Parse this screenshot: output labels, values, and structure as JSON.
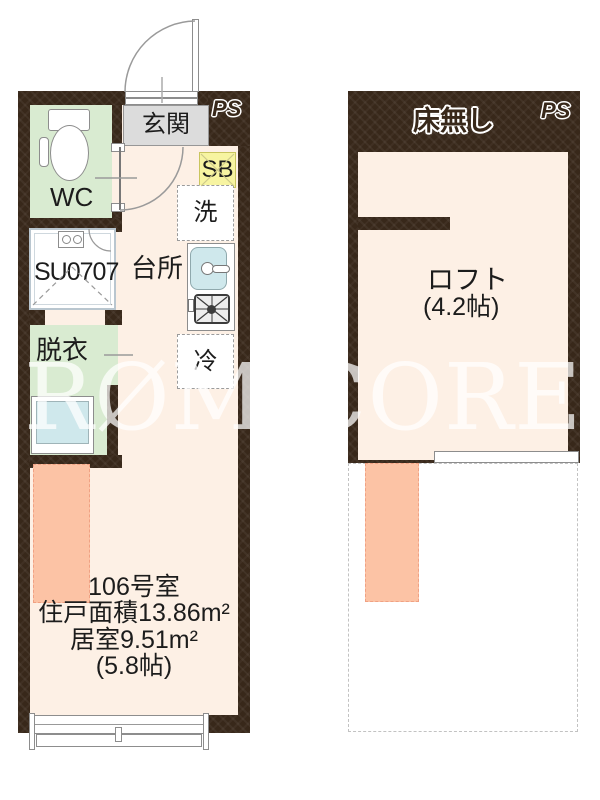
{
  "watermark": "RØM CORE",
  "colors": {
    "wall": "#38281a",
    "floor": "#fdf0e5",
    "wet_room_green": "#d9ebd1",
    "entry_gray": "#dcdcdc",
    "shoe_box_yellow": "#f7f4a1",
    "fixture_blue": "#cfe8ec",
    "loft_highlight_salmon": "#fcc3a5"
  },
  "main_plan": {
    "entrance": "玄関",
    "ps": "PS",
    "wc": "WC",
    "shoe_box": "SB",
    "washer": "洗",
    "kitchen": "台所",
    "unit_bath": "SU0707",
    "dressing": "脱衣",
    "fridge": "冷",
    "room_number": "106号室",
    "unit_area": "住戸面積13.86m²",
    "living_area": "居室9.51m²",
    "living_tatami": "(5.8帖)"
  },
  "loft_plan": {
    "no_floor": "床無し",
    "ps": "PS",
    "loft": "ロフト",
    "loft_tatami": "(4.2帖)"
  }
}
